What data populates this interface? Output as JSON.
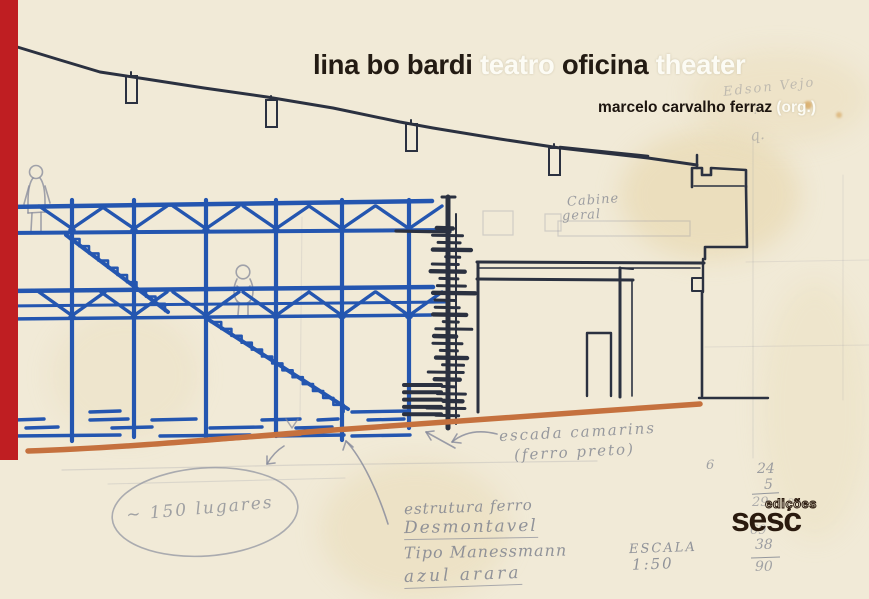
{
  "title": {
    "part1": "lina bo bardi",
    "part2": "teatro",
    "part3": "oficina",
    "part4": "theater"
  },
  "byline": {
    "name": "marcelo carvalho ferraz",
    "org": "(org.)"
  },
  "publisher": {
    "imprint": "edições",
    "name": "sesc"
  },
  "pencil_notes": {
    "top_right_1": "Edson Vejo",
    "top_right_2": "?",
    "top_right_3": "q.",
    "cabine_1": "Cabine",
    "cabine_2": "geral",
    "stair_1": "escada camarins",
    "stair_2": "(ferro preto)",
    "structure_1": "estrutura ferro",
    "structure_2": "Desmontavel",
    "structure_3": "Tipo Manessmann",
    "structure_4": "azul arara",
    "scale_1": "ESCALA",
    "scale_2": "1:50",
    "seats": "~ 150 lugares",
    "sum_left": "6",
    "sum_1": "24",
    "sum_2": "5",
    "sum_3": "29",
    "sum_4": "20",
    "sum_5": "69",
    "sum_6": "38",
    "sum_7": "90"
  },
  "colors": {
    "spine_red": "#bf1e22",
    "marker_blue": "#2456b0",
    "ink_dark": "#2b3140",
    "ground_orange": "#c5713e",
    "pencil_gray": "#84889a",
    "title_dark": "#231b13",
    "title_light": "#fcfbf4",
    "logo_dark": "#2a1a0e",
    "paper": "#f1ead7"
  }
}
